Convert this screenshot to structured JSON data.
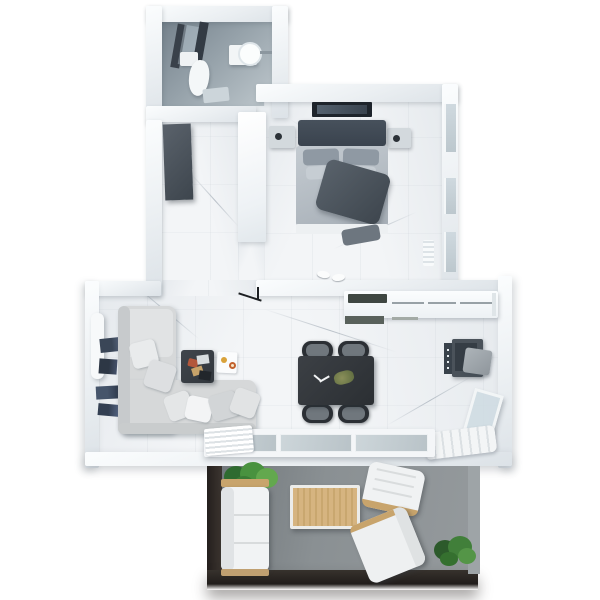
{
  "scene": {
    "type": "floor-plan-3d-top-view",
    "description": "3D rendered top-down floor plan of a one-bedroom apartment with balcony, white walls and marble floors"
  },
  "palette": {
    "wall": "#eef1f4",
    "marble_floor": "#f3f5f7",
    "bathroom_floor": "#96a2aa",
    "balcony_floor": "#8a9093",
    "balcony_edge": "#241f1d",
    "dark_furniture": "#3d444c",
    "wood": "#cda96f",
    "plant_green": "#49923f",
    "sofa_gray": "#d6d8d9",
    "glass": "#c4ced4",
    "accent_orange": "#d9a23a"
  },
  "rooms": {
    "bathroom": {
      "label": "Bathroom",
      "items": [
        "shower with glass panels",
        "toilet",
        "round sink on vanity",
        "bath mat"
      ]
    },
    "hallway": {
      "label": "Hallway",
      "items": [
        "dark wardrobe",
        "built-in closet"
      ]
    },
    "bedroom": {
      "label": "Bedroom",
      "items": [
        "double bed with dark blanket",
        "two nightstands",
        "wall TV",
        "radiator",
        "slippers",
        "windows"
      ]
    },
    "living_room": {
      "label": "Living room",
      "items": [
        "L-shaped corner sofa with pillows",
        "dark coffee table",
        "wall book shelves",
        "radiator",
        "floor lamp",
        "deco card"
      ]
    },
    "kitchen": {
      "label": "Kitchen / dining",
      "items": [
        "counter with cooktop",
        "dark dining table",
        "four chairs",
        "desk with chair",
        "leaning glass pane",
        "quilted mat"
      ]
    },
    "balcony": {
      "label": "Balcony",
      "items": [
        "outdoor sofa",
        "wooden coffee table",
        "two armchairs",
        "two green plants"
      ]
    }
  },
  "furniture": {
    "shower": "Shower with dark glass panels",
    "toilet": "Toilet",
    "sink": "Round sink on vanity",
    "bath_mat": "Bath mat",
    "wardrobe": "Dark wardrobe",
    "closet": "Built-in closet",
    "tv": "Wall-mounted TV",
    "bed": "Double bed",
    "blanket": "Dark gray blanket",
    "nightstand": "Nightstand",
    "radiator": "Radiator",
    "window": "Window",
    "slippers": "Slippers",
    "floor_lamp": "Floor lamp",
    "bookshelf": "Wall book shelves",
    "sofa": "L-shaped corner sofa",
    "pillow": "Throw pillow",
    "coffee_table": "Coffee table",
    "deco_card": "Deco card with coasters",
    "counter": "Kitchen counter",
    "cooktop": "Cooktop",
    "dining_table": "Dining table",
    "chair": "Dining chair",
    "desk": "Desk unit",
    "desk_chair": "Desk chair",
    "glass_doors": "Sliding glass doors to balcony",
    "door_rug": "Ribbed door rug",
    "quilted_mat": "Quilted mat",
    "corner_window": "Leaning glass pane",
    "balcony_sofa": "Outdoor sofa",
    "balcony_table": "Outdoor wooden coffee table",
    "armchair": "Outdoor armchair",
    "plant": "Potted plant"
  }
}
